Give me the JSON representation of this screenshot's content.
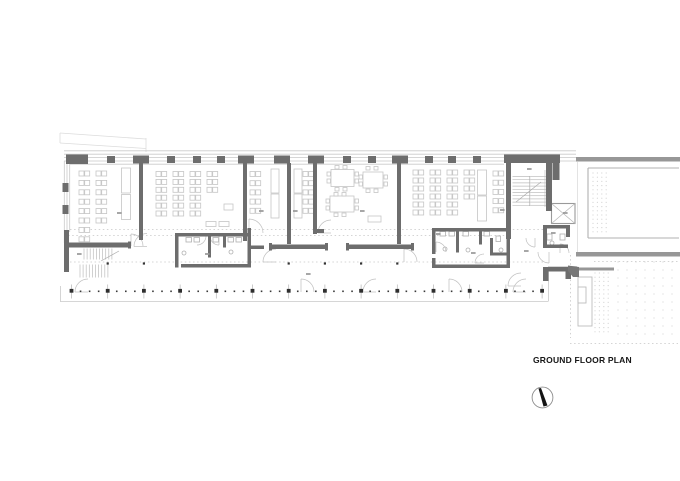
{
  "annotations": {
    "title": "GROUND FLOOR PLAN"
  },
  "palette": {
    "wall": "#6d6d6d",
    "wallDark": "#2f2f2f",
    "medium": "#979797",
    "light": "#c9c9c9",
    "furn": "#c9c9c9",
    "dotted": "#c6c6c6",
    "faint": "#dcdcdc",
    "texture": "#d6d6d6",
    "smudge": "#989898"
  },
  "plan": {
    "walls": [
      [
        66,
        154.5,
        22,
        9.5
      ],
      [
        107,
        156,
        8,
        7
      ],
      [
        167,
        156,
        8,
        7
      ],
      [
        193,
        156,
        8,
        7
      ],
      [
        217,
        156,
        8,
        7
      ],
      [
        343,
        156,
        8,
        7
      ],
      [
        368,
        156,
        8,
        7
      ],
      [
        425,
        156,
        8,
        7
      ],
      [
        448,
        156,
        8,
        7
      ],
      [
        473,
        156,
        8,
        7
      ],
      [
        133,
        155.5,
        16,
        8
      ],
      [
        238,
        155.5,
        16,
        8
      ],
      [
        274,
        155.5,
        16,
        8
      ],
      [
        308,
        155.5,
        16,
        8
      ],
      [
        392,
        155.5,
        16,
        8
      ],
      [
        504,
        154.5,
        56,
        8.5
      ],
      [
        552.5,
        163,
        7,
        17
      ],
      [
        62.5,
        183,
        6,
        9
      ],
      [
        62.5,
        205,
        6,
        9
      ],
      [
        64,
        230,
        5,
        42
      ],
      [
        64,
        242.5,
        67,
        5
      ],
      [
        128,
        241.5,
        3,
        7
      ],
      [
        139,
        163,
        4,
        77
      ],
      [
        243,
        163,
        4,
        78
      ],
      [
        287,
        163,
        4,
        81
      ],
      [
        313,
        163,
        4,
        71
      ],
      [
        313,
        229,
        11,
        4
      ],
      [
        397,
        163,
        4,
        81
      ],
      [
        270,
        244.5,
        57,
        4.5
      ],
      [
        269,
        243,
        3,
        7.5
      ],
      [
        325,
        243,
        3,
        7.5
      ],
      [
        347,
        244.5,
        67,
        4.5
      ],
      [
        346,
        243,
        3,
        7.5
      ],
      [
        411,
        243,
        3,
        7.5
      ],
      [
        506,
        163,
        5,
        76
      ],
      [
        546,
        163,
        6,
        48
      ],
      [
        175,
        233,
        76,
        3.5
      ],
      [
        175,
        233,
        3.5,
        34.5
      ],
      [
        181,
        264,
        70,
        3.5
      ],
      [
        247.5,
        228,
        3.5,
        39.5
      ],
      [
        251,
        245.5,
        13,
        3.5
      ],
      [
        208,
        236.5,
        3,
        21
      ],
      [
        223,
        236.5,
        3,
        11
      ],
      [
        432,
        228,
        78,
        3.5
      ],
      [
        432,
        228,
        3.5,
        26
      ],
      [
        432,
        258,
        3.5,
        10
      ],
      [
        432,
        264.5,
        78,
        3.5
      ],
      [
        506.5,
        228,
        3.5,
        40
      ],
      [
        456,
        231.5,
        3,
        21
      ],
      [
        479,
        231.5,
        3,
        13
      ],
      [
        490,
        238,
        3,
        17.5
      ],
      [
        490,
        252.5,
        17,
        3
      ],
      [
        543,
        225,
        27,
        3.5
      ],
      [
        543,
        225,
        4,
        23
      ],
      [
        543,
        244.5,
        25,
        3.5
      ],
      [
        566,
        225,
        4,
        12
      ],
      [
        543,
        267,
        30,
        4.5
      ],
      [
        543,
        271,
        5.5,
        10
      ],
      [
        565.5,
        271,
        5.5,
        8
      ]
    ],
    "polys": [
      {
        "pts": [
          [
            568,
            265.5
          ],
          [
            579,
            267
          ],
          [
            579,
            277
          ],
          [
            573,
            277
          ],
          [
            568,
            271
          ]
        ],
        "fill": "#777777"
      }
    ],
    "mediumWalls": [
      [
        576,
        157,
        104,
        4.5
      ],
      [
        576,
        252,
        104,
        4.5
      ],
      [
        577,
        267.5,
        37,
        3
      ]
    ],
    "mediumLines": [
      [
        588,
        168,
        679,
        168
      ],
      [
        588,
        168,
        588,
        238
      ],
      [
        588,
        238,
        679,
        238
      ]
    ],
    "faintLines": [
      [
        60,
        133,
        146,
        139
      ],
      [
        60,
        143,
        146,
        148.5
      ],
      [
        146,
        138,
        146,
        152
      ],
      [
        60,
        133,
        60,
        143
      ],
      [
        577.5,
        162,
        577.5,
        252
      ]
    ],
    "faintRects": [
      [
        578,
        277,
        14,
        49
      ],
      [
        578,
        287,
        8,
        16
      ]
    ],
    "lightLines": [
      [
        64,
        150.8,
        576,
        150.8
      ],
      [
        64,
        154.2,
        576,
        154.2
      ],
      [
        64,
        157.6,
        576,
        157.6
      ],
      [
        64,
        161,
        576,
        161
      ],
      [
        64.3,
        161,
        64.3,
        243
      ],
      [
        67,
        161,
        67,
        243
      ],
      [
        69.7,
        161,
        69.7,
        232
      ],
      [
        70,
        164.2,
        504,
        164.2
      ],
      [
        60,
        301.5,
        548,
        301.5
      ],
      [
        60.5,
        286,
        60.5,
        301.5
      ],
      [
        548.5,
        266,
        548.5,
        301.5
      ],
      [
        549,
        266.5,
        577,
        266.5
      ],
      [
        545,
        170,
        545,
        207
      ],
      [
        549,
        170,
        549,
        207
      ]
    ],
    "dottedLines": [
      [
        70,
        229.5,
        543,
        229.5
      ],
      [
        64,
        235.5,
        510,
        235.5
      ],
      [
        70,
        262,
        543,
        262
      ],
      [
        594,
        261.5,
        678,
        261.5
      ],
      [
        570.5,
        255,
        570.5,
        338
      ],
      [
        570,
        343.5,
        678,
        343.5
      ]
    ],
    "pairColumns": [
      {
        "x": 79,
        "y": 171,
        "rows": 8,
        "dy": 9.4
      },
      {
        "x": 96,
        "y": 171,
        "rows": 6,
        "dy": 9.4
      },
      {
        "x": 156,
        "y": 171.5,
        "rows": 6,
        "dy": 7.9
      },
      {
        "x": 173,
        "y": 171.5,
        "rows": 6,
        "dy": 7.9
      },
      {
        "x": 190,
        "y": 171.5,
        "rows": 6,
        "dy": 7.9
      },
      {
        "x": 207,
        "y": 171.5,
        "rows": 3,
        "dy": 7.9
      },
      {
        "x": 250,
        "y": 171.5,
        "rows": 5,
        "dy": 9.2
      },
      {
        "x": 303,
        "y": 171.5,
        "rows": 5,
        "dy": 9.2
      },
      {
        "x": 413,
        "y": 170,
        "rows": 6,
        "dy": 8
      },
      {
        "x": 430,
        "y": 170,
        "rows": 6,
        "dy": 8
      },
      {
        "x": 447,
        "y": 170,
        "rows": 6,
        "dy": 8
      },
      {
        "x": 464,
        "y": 170,
        "rows": 4,
        "dy": 8
      },
      {
        "x": 493,
        "y": 171,
        "rows": 5,
        "dy": 9.2
      }
    ],
    "lightRects": [
      [
        121.5,
        168,
        9,
        25
      ],
      [
        121.5,
        194.5,
        9,
        25
      ],
      [
        271,
        169,
        8,
        24
      ],
      [
        271,
        194,
        8,
        24
      ],
      [
        294,
        169,
        8,
        24
      ],
      [
        294,
        194,
        8,
        24
      ],
      [
        477.5,
        170,
        9,
        25
      ],
      [
        477.5,
        196,
        9,
        25
      ],
      [
        331,
        169.5,
        23,
        17
      ],
      [
        330,
        196,
        24,
        16
      ],
      [
        363,
        172,
        20,
        16
      ],
      [
        368,
        216,
        13,
        6
      ],
      [
        206,
        221.5,
        10,
        5
      ],
      [
        219,
        221.5,
        10,
        5
      ],
      [
        224,
        204,
        9,
        6
      ],
      [
        327,
        172,
        3.5,
        4
      ],
      [
        327,
        179,
        3.5,
        4
      ],
      [
        355,
        172,
        3.5,
        4
      ],
      [
        355,
        179,
        3.5,
        4
      ],
      [
        335,
        165.5,
        4,
        3.5
      ],
      [
        343,
        165.5,
        4,
        3.5
      ],
      [
        335,
        187.5,
        4,
        3.5
      ],
      [
        343,
        187.5,
        4,
        3.5
      ],
      [
        326,
        199,
        3.5,
        4
      ],
      [
        326,
        206,
        3.5,
        4
      ],
      [
        355,
        199,
        3.5,
        4
      ],
      [
        355,
        206,
        3.5,
        4
      ],
      [
        334,
        192.5,
        4,
        3.5
      ],
      [
        342,
        192.5,
        4,
        3.5
      ],
      [
        334,
        213,
        4,
        3.5
      ],
      [
        342,
        213,
        4,
        3.5
      ],
      [
        359,
        175,
        3.5,
        4
      ],
      [
        359,
        182,
        3.5,
        4
      ],
      [
        384,
        175,
        3.5,
        4
      ],
      [
        384,
        182,
        3.5,
        4
      ],
      [
        366,
        166.5,
        4,
        3.5
      ],
      [
        374,
        166.5,
        4,
        3.5
      ],
      [
        366,
        189,
        4,
        3.5
      ],
      [
        374,
        189,
        4,
        3.5
      ]
    ],
    "fixtures": [
      [
        186,
        237.5,
        5.5,
        4.5
      ],
      [
        194,
        237.5,
        5.5,
        4.5
      ],
      [
        213,
        237.5,
        5.5,
        4.5
      ],
      [
        228,
        237.5,
        5.5,
        4.5
      ],
      [
        236,
        237.5,
        5.5,
        4.5
      ],
      [
        440,
        231.5,
        5.5,
        4.5
      ],
      [
        449,
        231.5,
        5.5,
        4.5
      ],
      [
        463,
        231.5,
        5.5,
        4.5
      ],
      [
        484,
        231.5,
        5.5,
        4.5
      ],
      [
        496,
        236,
        4.5,
        5.5
      ],
      [
        547,
        234,
        5,
        6
      ],
      [
        560,
        234,
        5,
        6
      ]
    ],
    "circlesLight": [
      [
        184,
        253,
        2
      ],
      [
        231,
        252,
        2
      ],
      [
        445,
        249,
        2
      ],
      [
        468,
        250,
        2
      ],
      [
        501,
        250,
        2
      ],
      [
        552,
        243,
        2
      ]
    ],
    "arcs": [
      {
        "cx": 147,
        "cy": 246.5,
        "r": 13,
        "a0": 180,
        "a1": 270
      },
      {
        "cx": 131,
        "cy": 246,
        "r": 12,
        "a0": 270,
        "a1": 360
      },
      {
        "cx": 249,
        "cy": 233,
        "r": 14,
        "a0": 270,
        "a1": 360
      },
      {
        "cx": 331,
        "cy": 233,
        "r": 13,
        "a0": 180,
        "a1": 270
      },
      {
        "cx": 276,
        "cy": 262,
        "r": 13,
        "a0": 180,
        "a1": 270
      },
      {
        "cx": 404,
        "cy": 262,
        "r": 13,
        "a0": 270,
        "a1": 360
      },
      {
        "cx": 197,
        "cy": 236,
        "r": 9,
        "a0": 0,
        "a1": 90
      },
      {
        "cx": 219,
        "cy": 236,
        "r": 9,
        "a0": 90,
        "a1": 180
      },
      {
        "cx": 436,
        "cy": 252,
        "r": 10,
        "a0": 270,
        "a1": 360
      },
      {
        "cx": 484,
        "cy": 263,
        "r": 9,
        "a0": 180,
        "a1": 270
      },
      {
        "cx": 535,
        "cy": 238,
        "r": 9,
        "a0": 90,
        "a1": 180
      },
      {
        "cx": 549,
        "cy": 252,
        "r": 11,
        "a0": 90,
        "a1": 180
      },
      {
        "cx": 521,
        "cy": 286,
        "r": 13,
        "a0": 180,
        "a1": 270
      },
      {
        "cx": 560,
        "cy": 253,
        "r": 9,
        "a0": 270,
        "a1": 360
      },
      {
        "cx": 88,
        "cy": 292,
        "r": 13,
        "a0": 180,
        "a1": 270
      },
      {
        "cx": 301,
        "cy": 292,
        "r": 13,
        "a0": 270,
        "a1": 360
      },
      {
        "cx": 376,
        "cy": 292,
        "r": 13,
        "a0": 180,
        "a1": 270
      },
      {
        "cx": 449,
        "cy": 292,
        "r": 13,
        "a0": 270,
        "a1": 360
      },
      {
        "cx": 526,
        "cy": 292,
        "r": 13,
        "a0": 180,
        "a1": 270
      }
    ],
    "stairs": [
      {
        "x0": 84,
        "x1": 114,
        "y0": 248.5,
        "y1": 259.5,
        "step": 3.1,
        "vertical": true
      },
      {
        "x0": 80,
        "x1": 108,
        "y0": 264.5,
        "y1": 277.5,
        "step": 3.1,
        "vertical": true
      },
      {
        "x0": 512.5,
        "x1": 529.5,
        "y0": 176.5,
        "y1": 205.5,
        "step": 3.2,
        "vertical": false
      },
      {
        "x0": 530.2,
        "x1": 546,
        "y0": 176.5,
        "y1": 205.5,
        "step": 3.2,
        "vertical": false
      }
    ],
    "stairExtras": [
      [
        529.8,
        176,
        529.8,
        206
      ],
      [
        516,
        202,
        541,
        182
      ],
      [
        101,
        261,
        119,
        251
      ]
    ],
    "elevator": {
      "x": 551.5,
      "y": 203.5,
      "w": 23.5,
      "h": 20
    },
    "columns": {
      "y": 290.8,
      "x0": 71.5,
      "step": 36.2,
      "count": 14,
      "dotStep": 9.05,
      "tickTop": 284.5,
      "tickBottom": 298.5
    },
    "interiorDots": {
      "y": 263.5,
      "s": 2.2,
      "xs": [
        107.7,
        143.9,
        288.7,
        324.9,
        361.1,
        397.3
      ]
    },
    "textures": [
      {
        "x0": 593,
        "y0": 173,
        "x1": 610,
        "y1": 232,
        "dx": 4.4,
        "dy": 4.2
      },
      {
        "x0": 595,
        "y0": 273,
        "x1": 612,
        "y1": 335,
        "dx": 4.4,
        "dy": 4.2
      },
      {
        "x0": 618,
        "y0": 262,
        "x1": 676,
        "y1": 340,
        "dx": 9,
        "dy": 8
      }
    ],
    "room_label_marks": [
      [
        117,
        212
      ],
      [
        77,
        253
      ],
      [
        205,
        253
      ],
      [
        306,
        273
      ],
      [
        259,
        210
      ],
      [
        293,
        210
      ],
      [
        360,
        210
      ],
      [
        500,
        209
      ],
      [
        471,
        252
      ],
      [
        527,
        168
      ],
      [
        563,
        212
      ],
      [
        524,
        250
      ],
      [
        551,
        232
      ],
      [
        436,
        233
      ]
    ]
  }
}
